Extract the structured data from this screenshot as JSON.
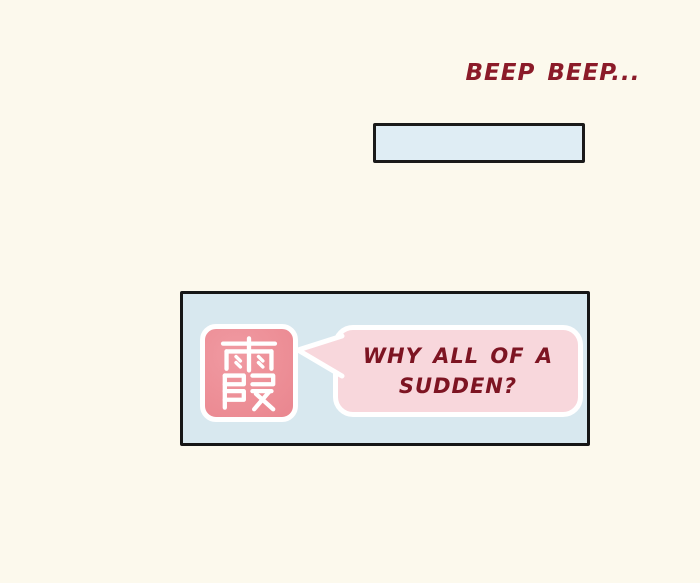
{
  "page": {
    "kind": "comic-panel-page",
    "background_color": "#FCF9ED"
  },
  "sfx": {
    "text": "BEEP BEEP...",
    "color": "#8B1B29"
  },
  "phone_panel": {
    "fill": "#DFEDF4",
    "border_color": "#1A1A1A"
  },
  "main_panel": {
    "fill": "#D8E8EF",
    "border_color": "#161616",
    "avatar": {
      "character": "霞",
      "fill": "#ED8F97",
      "glyph_color": "#FFFFFF",
      "border_color": "#FFFFFF"
    },
    "speech_bubble": {
      "line1": "WHY ALL OF A",
      "line2": "SUDDEN?",
      "fill": "#F8D7DC",
      "border_color": "#FFFFFF",
      "text_color": "#7D1422"
    }
  }
}
